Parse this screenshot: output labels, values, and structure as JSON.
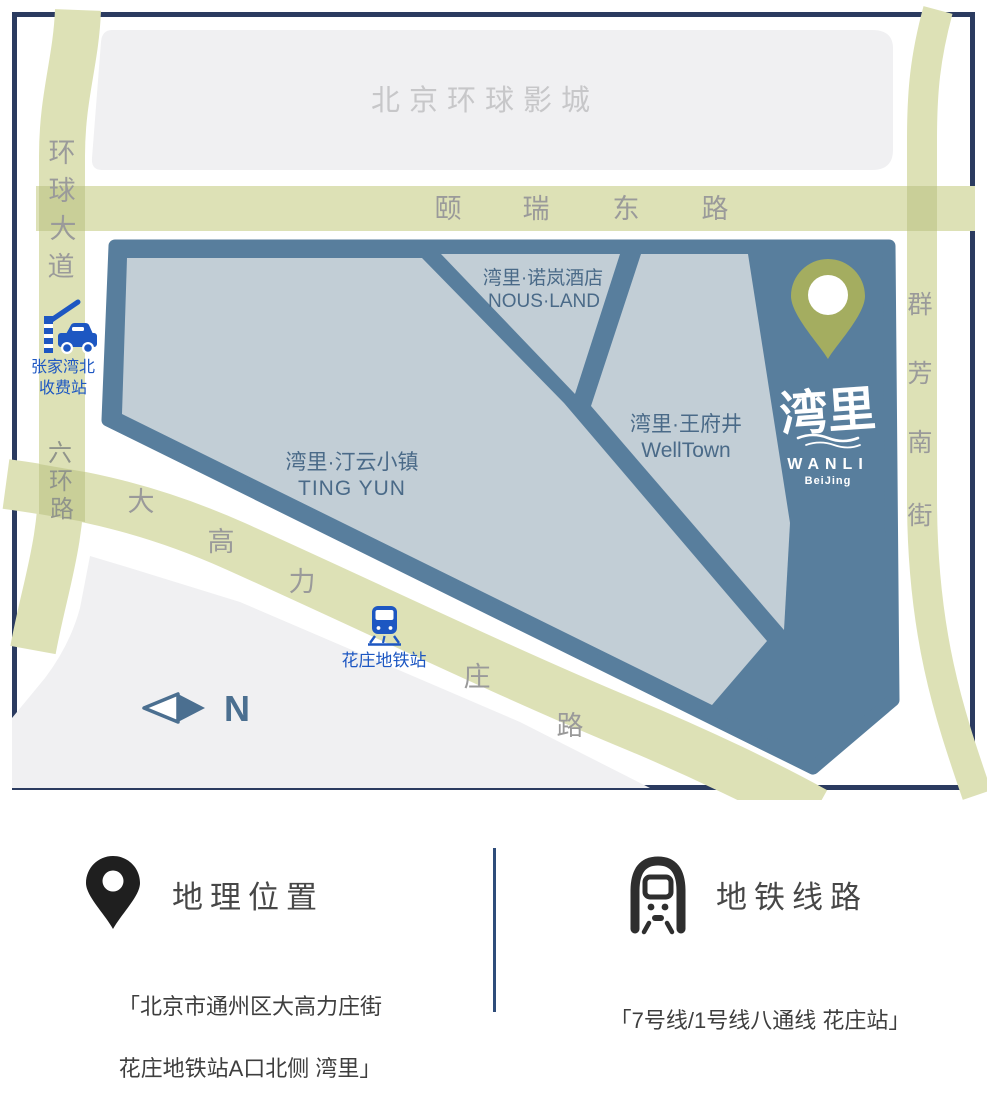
{
  "colors": {
    "map_border": "#2b3b60",
    "road_olive": "#dde1b6",
    "road_olive_overlap": "#c9cf98",
    "compound_dark_blue": "#587e9d",
    "parcel_light_blue": "#c2ced6",
    "parcel_text_blue": "#4a6a88",
    "area_gray": "#f0f0f2",
    "road_label_gray": "#9a9a9a",
    "area_label_gray": "#c7c7c9",
    "poi_blue": "#1d57c2",
    "pin_olive": "#a4ad60",
    "compass_blue": "#4b6f90",
    "info_divider_navy": "#2f4d7a",
    "info_text_dark": "#3e3e3e"
  },
  "map": {
    "area_label": "北京环球影城",
    "roads": {
      "yirui_east": {
        "name": "颐瑞东路",
        "chars": [
          "颐",
          "瑞",
          "东",
          "路"
        ]
      },
      "huanqiu_ave": {
        "name": "环球大道",
        "chars": [
          "环",
          "球",
          "大",
          "道"
        ]
      },
      "sixth_ring": {
        "name": "六环路",
        "chars": [
          "六",
          "环",
          "路"
        ]
      },
      "qunfang_south": {
        "name": "群芳南街",
        "chars": [
          "群",
          "芳",
          "南",
          "街"
        ]
      },
      "dagaolizhuang": {
        "name": "大高力庄路",
        "chars": [
          "大",
          "高",
          "力",
          "庄",
          "路"
        ]
      }
    },
    "parcels": {
      "tingyun": {
        "name_cn": "湾里·汀云小镇",
        "name_en": "TING YUN"
      },
      "nousland": {
        "name_cn": "湾里·诺岚酒店",
        "name_en": "NOUS·LAND"
      },
      "welltown": {
        "name_cn": "湾里·王府井",
        "name_en": "WellTown"
      }
    },
    "logo": {
      "cn": "湾里",
      "en": "WANLI",
      "city": "BeiJing"
    },
    "toll": {
      "line1": "张家湾北",
      "line2": "收费站"
    },
    "metro_station": "花庄地铁站",
    "compass": "N"
  },
  "info": {
    "location": {
      "title": "地理位置",
      "line1": "「北京市通州区大高力庄街",
      "line2": "花庄地铁站A口北侧 湾里」"
    },
    "metro": {
      "title": "地铁线路",
      "line1": "「7号线/1号线八通线 花庄站」"
    }
  }
}
